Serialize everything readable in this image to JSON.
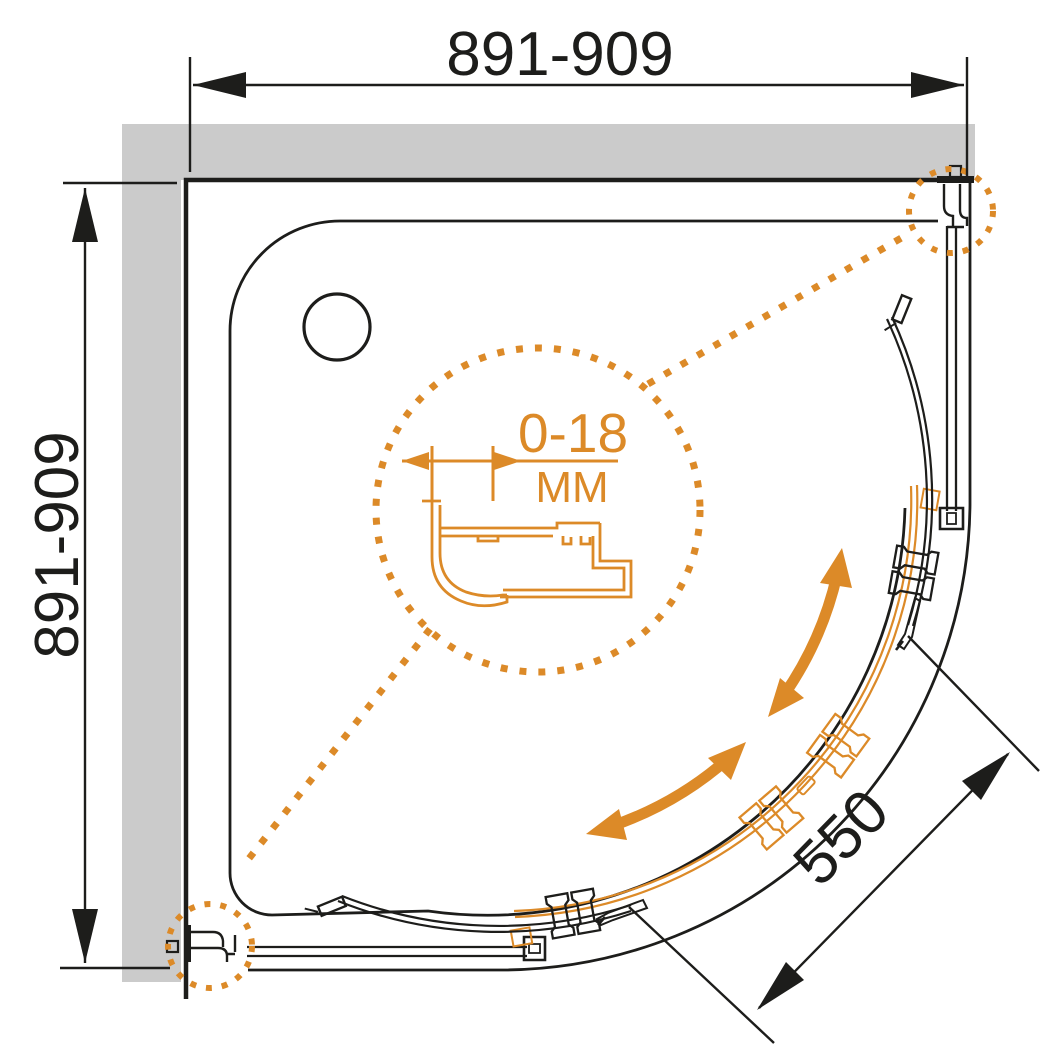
{
  "drawing": {
    "title": "shower-enclosure-technical-drawing",
    "dimensions": {
      "width_label": "891-909",
      "height_label": "891-909",
      "radius_label": "550",
      "detail_range": "0-18",
      "detail_unit": "ММ"
    },
    "colors": {
      "accent": "#DC8A28",
      "line": "#1D1D1B",
      "wall": "#CBCBCB",
      "bg": "#FFFFFF"
    },
    "icons": {
      "slide_direction": "curved-double-arrow-icon",
      "detail_callout": "dotted-circle-icon",
      "drain": "drain-circle-icon",
      "wall_profile": "aluminium-profile-section-icon"
    }
  }
}
